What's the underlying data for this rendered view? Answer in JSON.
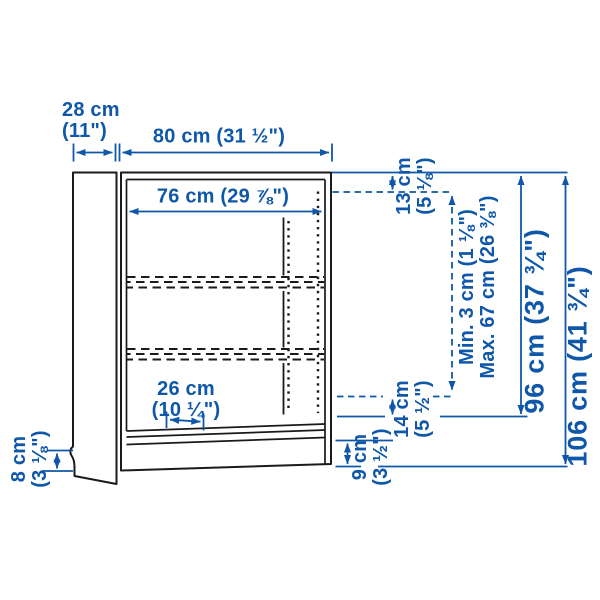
{
  "diagram": {
    "subject": "bookcase-dimension-drawing",
    "colors": {
      "dimension_blue": "#0F57A8",
      "outline_black": "#1a1a1a",
      "background": "#FFFFFF"
    },
    "labels": {
      "depth": {
        "line1": "28 cm",
        "line2": "(11\")"
      },
      "width": {
        "text": "80 cm (31 ½\")"
      },
      "inner_width": {
        "text": "76 cm (29 ⅞\")"
      },
      "top_offset": {
        "line1": "13 cm",
        "line2": "(5 ⅛\")"
      },
      "shelf_adjust": {
        "line1": "Min. 3 cm (1 ⅛\")",
        "line2": "Max. 67 cm (26 ⅜\")"
      },
      "inner_height": {
        "text": "96 cm (37 ¾\")"
      },
      "total_height": {
        "text": "106 cm (41 ¾\")"
      },
      "bottom_offset": {
        "line1": "14 cm",
        "line2": "(5 ½\")"
      },
      "plinth_height": {
        "line1": "9 cm",
        "line2": "(3 ½\")"
      },
      "foot_height": {
        "line1": "8 cm",
        "line2": "(3 ⅛\")"
      },
      "shelf_depth": {
        "line1": "26 cm",
        "line2": "(10 ¼\")"
      }
    }
  }
}
